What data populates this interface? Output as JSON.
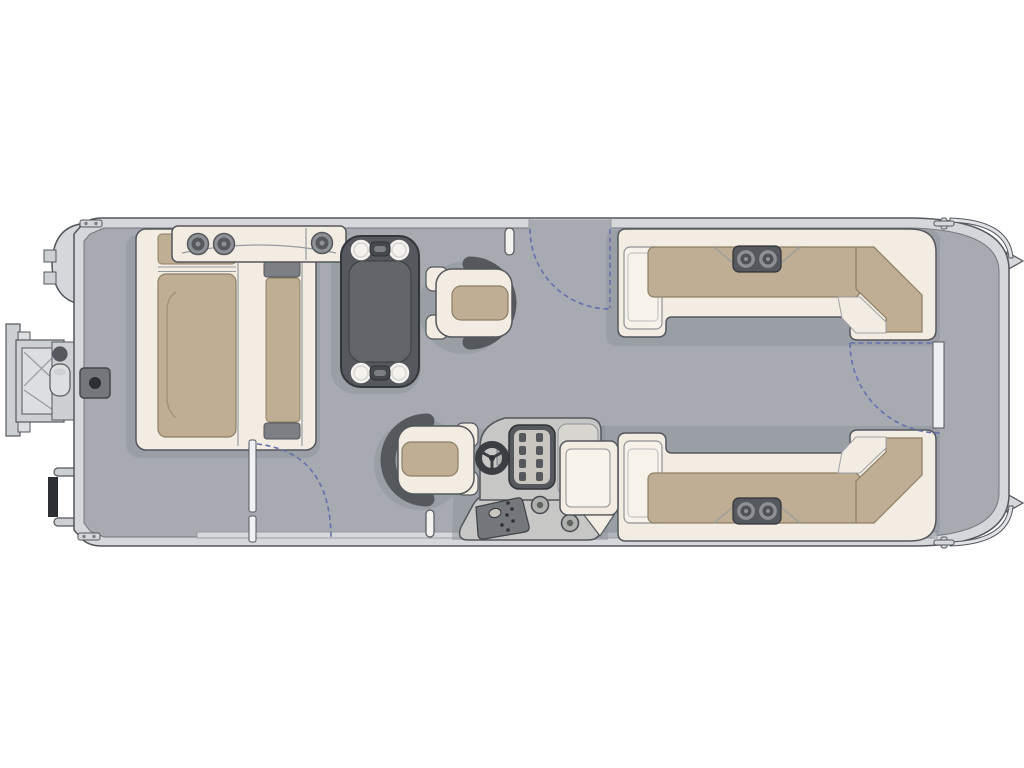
{
  "diagram": {
    "type": "pontoon-boat-floor-plan",
    "view": "top-down"
  },
  "components": [
    {
      "id": "bow-ladder",
      "label": "folding boarding ladder"
    },
    {
      "id": "bow-nose",
      "label": "bow nose cone"
    },
    {
      "id": "ski-tow-base",
      "label": "deck tow / pylon base"
    },
    {
      "id": "bow-lounge",
      "label": "port bow L-lounge with tan cushions"
    },
    {
      "id": "bow-lounge-console",
      "label": "bow armrest console with cup holders"
    },
    {
      "id": "bow-bench",
      "label": "rear-facing bow bench"
    },
    {
      "id": "table",
      "label": "removable table with four cup holders"
    },
    {
      "id": "port-captain-chair",
      "label": "swivel chair facing table"
    },
    {
      "id": "helm-chair",
      "label": "captain helm chair"
    },
    {
      "id": "helm-console",
      "label": "helm console with steering wheel, dashboard, switch panel and speakers"
    },
    {
      "id": "stern-lounge-port",
      "label": "aft L-lounge (top) with cup holders"
    },
    {
      "id": "stern-lounge-starboard",
      "label": "aft L-lounge (bottom) with cup holders"
    },
    {
      "id": "port-gate-swing",
      "label": "side boarding gate swing arc"
    },
    {
      "id": "bow-gate-swing",
      "label": "bow boarding gate swing arc"
    },
    {
      "id": "stern-gate-swing",
      "label": "stern gate swing arc"
    },
    {
      "id": "stern-platform",
      "label": "stern deck platform with cleats"
    },
    {
      "id": "grab-handle",
      "label": "grab handle pill"
    },
    {
      "id": "walkway",
      "label": "gray vinyl deck walkway"
    }
  ],
  "colors": {
    "background": "#ffffff",
    "deck": "#a7abb1",
    "hull_band": "#d5d7da",
    "hull_cap": "#e0e2e5",
    "outline": "#54575c",
    "upholstery_cream": "#f2ece2",
    "upholstery_inner": "#f7f2ea",
    "upholstery_edge": "#979ba1",
    "cushion_tan": "#bfae93",
    "cushion_tan_outline": "#8c7f66",
    "cushion_stitch": "#a2937a",
    "furniture_dark": "#55585d",
    "furniture_darker": "#3a3d41",
    "table_inner": "#62656a",
    "hardware_gray": "#7c7f84",
    "console_gray": "#c7c7c5",
    "panel_dark": "#74777c",
    "panel_cream": "#c9c6bf",
    "cup_ring": "#8d9095",
    "cup_white": "#f4f2ee",
    "gate_swing_blue": "#6570ae",
    "shadow": "#8e929a",
    "ladder_gray": "#ccd0d3",
    "ladder_light": "#dcdee0",
    "bumper_black": "#2c2f33"
  }
}
